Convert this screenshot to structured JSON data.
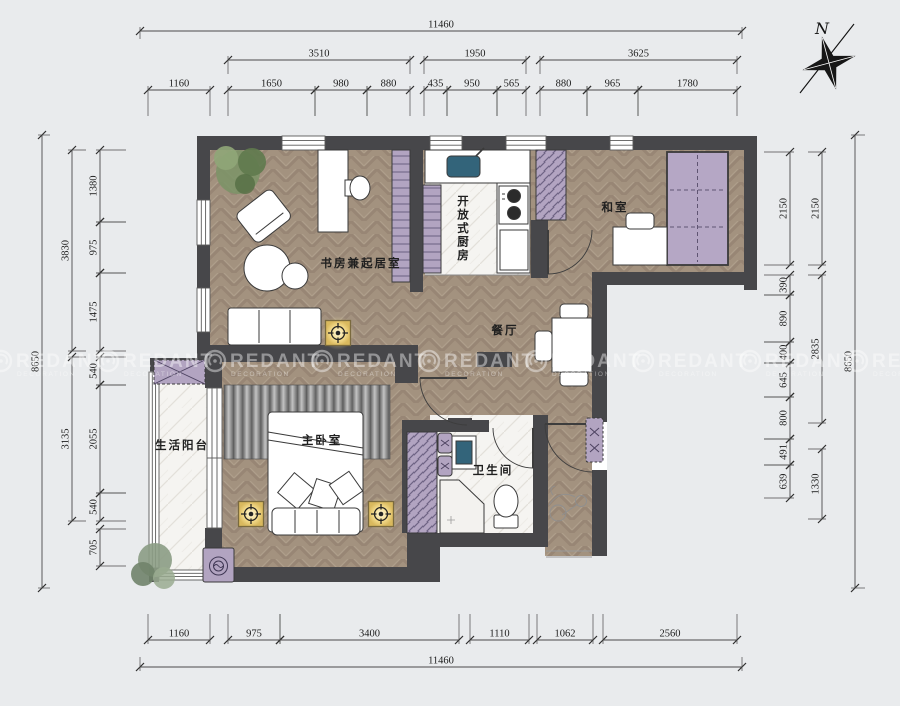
{
  "north_label": "N",
  "watermark": {
    "brand": "REDANT",
    "subtitle": "DECORATION"
  },
  "rooms": {
    "study": "书房兼起居室",
    "kitchen": "开放式厨房",
    "tatami_room": "和室",
    "dining": "餐厅",
    "balcony": "生活阳台",
    "master_bedroom": "主卧室",
    "bathroom": "卫生间"
  },
  "dimensions": {
    "top": {
      "total": "11460",
      "level2": [
        "3510",
        "1950",
        "3625"
      ],
      "level3": [
        "1160",
        "1650",
        "980",
        "880",
        "435",
        "950",
        "565",
        "880",
        "965",
        "1780"
      ]
    },
    "bottom": {
      "level1": [
        "1160",
        "975",
        "3400",
        "1110",
        "1062",
        "2560"
      ],
      "total": "11460"
    },
    "left": {
      "total": "8650",
      "level2": [
        "3830",
        "3135"
      ],
      "level3": [
        "1380",
        "975",
        "1475",
        "540",
        "2055",
        "540",
        "705"
      ]
    },
    "right": {
      "level3": [
        "2150",
        "390",
        "890",
        "400",
        "645",
        "800",
        "491",
        "639"
      ],
      "level2": [
        "2150",
        "2835",
        "1330"
      ],
      "total": "8650"
    }
  },
  "colors": {
    "background": "#e9ebed",
    "wall": "#47474a",
    "wood_floor": "#a3927f",
    "marble_floor": "#f5f4f1",
    "purple_furniture": "#b2a4c1",
    "tatami": "#b5a7c5",
    "lamp": "#f0d98a",
    "sink": "#33647a",
    "dimension_text": "#1c1c1c"
  }
}
